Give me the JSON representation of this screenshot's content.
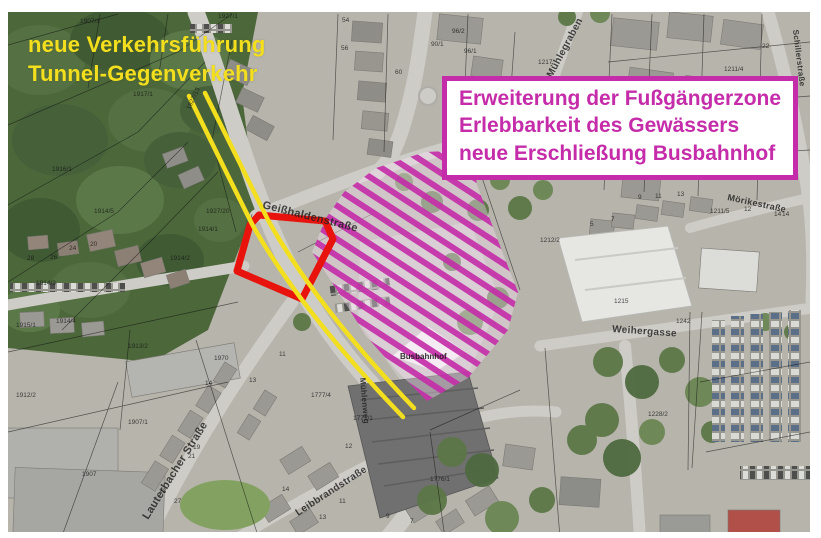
{
  "annotations": {
    "traffic_note": {
      "lines": [
        "neue Verkehrsführung",
        "Tunnel-Gegenverkehr"
      ]
    },
    "plan_box": {
      "lines": [
        "Erweiterung der Fußgängerzone",
        "Erlebbarkeit des Gewässers",
        "neue Erschließung Busbahnhof"
      ]
    }
  },
  "theme": {
    "route_yellow": "#f3df1e",
    "zone_red": "#e9130d",
    "magenta": "#c52ca9",
    "box_background": "#ffffff",
    "map_label_color": "#1c1c1c"
  },
  "map": {
    "street_labels": [
      {
        "text": "Geißhaldenstraße",
        "x": 262,
        "y": 208,
        "rotate": 14,
        "size": 11
      },
      {
        "text": "Mühlegraben",
        "x": 552,
        "y": 78,
        "rotate": -62,
        "size": 10
      },
      {
        "text": "Schillerstraße",
        "x": 793,
        "y": 30,
        "rotate": 83,
        "size": 8
      },
      {
        "text": "Mörikestraße",
        "x": 727,
        "y": 200,
        "rotate": 12,
        "size": 9
      },
      {
        "text": "Weihergasse",
        "x": 612,
        "y": 332,
        "rotate": 4,
        "size": 10
      },
      {
        "text": "Lauterbacher Straße",
        "x": 148,
        "y": 520,
        "rotate": -58,
        "size": 11
      },
      {
        "text": "Leibbrandstraße",
        "x": 298,
        "y": 516,
        "rotate": -33,
        "size": 10
      },
      {
        "text": "Mühlenweg",
        "x": 360,
        "y": 378,
        "rotate": 85,
        "size": 8
      }
    ],
    "area_labels": [
      {
        "text": "Busbahnhof",
        "x": 400,
        "y": 359,
        "rotate": 0,
        "size": 8
      }
    ],
    "parcel_labels": [
      {
        "text": "1907/3",
        "x": 80,
        "y": 23
      },
      {
        "text": "1927/1",
        "x": 218,
        "y": 18
      },
      {
        "text": "1917/1",
        "x": 133,
        "y": 96
      },
      {
        "text": "1927/13",
        "x": 190,
        "y": 110,
        "rotate": -65
      },
      {
        "text": "1916/1",
        "x": 52,
        "y": 171
      },
      {
        "text": "1914/5",
        "x": 94,
        "y": 213
      },
      {
        "text": "1927/20",
        "x": 206,
        "y": 213
      },
      {
        "text": "1914/1",
        "x": 198,
        "y": 231
      },
      {
        "text": "1914/2",
        "x": 170,
        "y": 260
      },
      {
        "text": "1914/3",
        "x": 36,
        "y": 285
      },
      {
        "text": "1915/1",
        "x": 16,
        "y": 327
      },
      {
        "text": "1914/4",
        "x": 56,
        "y": 323
      },
      {
        "text": "1913/2",
        "x": 128,
        "y": 348
      },
      {
        "text": "1912/2",
        "x": 16,
        "y": 397
      },
      {
        "text": "1907/1",
        "x": 128,
        "y": 424
      },
      {
        "text": "1907",
        "x": 82,
        "y": 476
      },
      {
        "text": "1217",
        "x": 538,
        "y": 64
      },
      {
        "text": "96/2",
        "x": 452,
        "y": 33
      },
      {
        "text": "90/1",
        "x": 431,
        "y": 46
      },
      {
        "text": "96/1",
        "x": 464,
        "y": 53
      },
      {
        "text": "1211/4",
        "x": 724,
        "y": 71
      },
      {
        "text": "1211/5",
        "x": 710,
        "y": 213
      },
      {
        "text": "1212/2",
        "x": 540,
        "y": 242
      },
      {
        "text": "1215",
        "x": 614,
        "y": 303
      },
      {
        "text": "1242",
        "x": 676,
        "y": 323
      },
      {
        "text": "1228/2",
        "x": 648,
        "y": 416
      },
      {
        "text": "1776/1",
        "x": 430,
        "y": 481
      },
      {
        "text": "1771/1",
        "x": 353,
        "y": 420
      },
      {
        "text": "1777/4",
        "x": 311,
        "y": 397
      },
      {
        "text": "1970",
        "x": 214,
        "y": 360
      },
      {
        "text": "13",
        "x": 249,
        "y": 382
      },
      {
        "text": "11",
        "x": 279,
        "y": 356
      },
      {
        "text": "14",
        "x": 205,
        "y": 385
      },
      {
        "text": "54",
        "x": 342,
        "y": 22
      },
      {
        "text": "56",
        "x": 341,
        "y": 50
      },
      {
        "text": "60",
        "x": 395,
        "y": 74
      },
      {
        "text": "22",
        "x": 762,
        "y": 48
      },
      {
        "text": "26",
        "x": 777,
        "y": 129
      },
      {
        "text": "20",
        "x": 785,
        "y": 164
      },
      {
        "text": "14",
        "x": 782,
        "y": 216
      },
      {
        "text": "12",
        "x": 744,
        "y": 211
      },
      {
        "text": "20",
        "x": 90,
        "y": 246
      },
      {
        "text": "24",
        "x": 69,
        "y": 250
      },
      {
        "text": "26",
        "x": 50,
        "y": 259
      },
      {
        "text": "28",
        "x": 27,
        "y": 260
      },
      {
        "text": "23",
        "x": 159,
        "y": 493
      },
      {
        "text": "21",
        "x": 188,
        "y": 458
      },
      {
        "text": "19",
        "x": 193,
        "y": 449
      },
      {
        "text": "27",
        "x": 174,
        "y": 503
      },
      {
        "text": "12",
        "x": 345,
        "y": 448
      },
      {
        "text": "11",
        "x": 339,
        "y": 503
      },
      {
        "text": "13",
        "x": 319,
        "y": 519
      },
      {
        "text": "9",
        "x": 386,
        "y": 518
      },
      {
        "text": "7",
        "x": 410,
        "y": 523
      },
      {
        "text": "14",
        "x": 282,
        "y": 491
      },
      {
        "text": "9",
        "x": 638,
        "y": 199
      },
      {
        "text": "11",
        "x": 655,
        "y": 198
      },
      {
        "text": "13",
        "x": 677,
        "y": 196
      },
      {
        "text": "5",
        "x": 590,
        "y": 226
      },
      {
        "text": "7",
        "x": 611,
        "y": 221
      },
      {
        "text": "14",
        "x": 774,
        "y": 216
      }
    ]
  }
}
